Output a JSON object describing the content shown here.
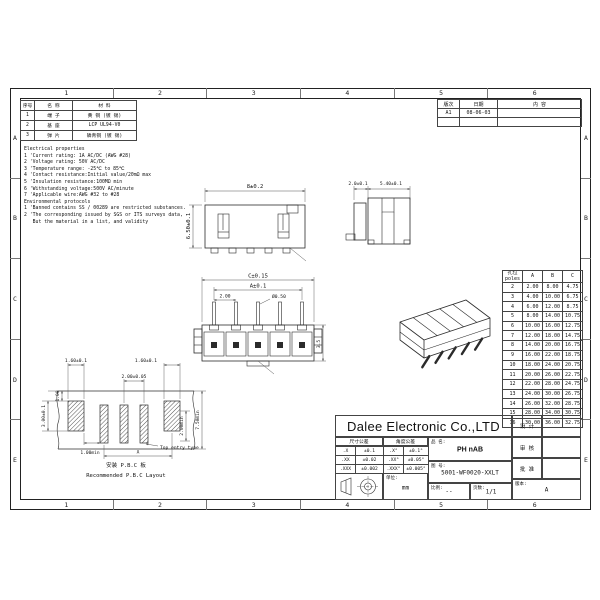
{
  "frame": {
    "cols": [
      "1",
      "2",
      "3",
      "4",
      "5",
      "6"
    ],
    "rows": [
      "A",
      "B",
      "C",
      "D",
      "E"
    ]
  },
  "materials_table": {
    "headers": [
      "序号",
      "名 称",
      "材 料"
    ],
    "rows": [
      [
        "1",
        "端 子",
        "黄 铜 (镀 锡)"
      ],
      [
        "2",
        "基 座",
        "LCP UL94-V0"
      ],
      [
        "3",
        "弹 片",
        "磷青铜 (镀 锡)"
      ]
    ]
  },
  "notes": {
    "lines": [
      "Electrical properties",
      "1 'Current rating: 1A AC/DC (AWG #28)",
      "2 'Voltage rating: 50V AC/DC",
      "3 'Temperature range: -25℃ to 85℃",
      "4 'Contact resistance:Initial value/20mΩ max",
      "5 'Insulation resistance:100MΩ min",
      "6 'Withstanding voltage:500V AC/minute",
      "7 'Applicable wire:AWG #32 to #28",
      "Environmental protocols",
      "1 'Banned contains SS / 00289 are restricted substances.",
      "2 'The corresponding issued by SGS or ITS surveys data,",
      "   But the material in a list, and validity"
    ]
  },
  "views": {
    "top_view": {
      "dim_width": "8±0.2",
      "dim_height": "6.50±0.1"
    },
    "side_view": {
      "dim_left": "2.0±0.1",
      "dim_right": "5.40±0.1"
    },
    "front_view": {
      "dim_c": "C±0.15",
      "dim_a": "A±0.1",
      "dim_pitch": "2.00",
      "dim_pin": "Ø0.50",
      "dim_height": "3.5"
    },
    "pcb_layout": {
      "dim_pad_left": "1.60±0.1",
      "dim_pad_right": "1.60±0.1",
      "dim_pitch": "2.00±0.05",
      "dim_edge": "1.00",
      "dim_pad_h": "3.00±0.1",
      "dim_gap": "1.00min",
      "dim_inner": "2.00min",
      "dim_outer": "7.50min",
      "dim_span": "A",
      "entry_label": "Top entry type",
      "caption_cn": "安装 P.B.C 板",
      "caption_en": "Recommended P.B.C Layout"
    }
  },
  "poles_table": {
    "header_cn": "孔位",
    "header_en": "poles",
    "cols": [
      "A",
      "B",
      "C"
    ],
    "rows": [
      [
        "2",
        "2.00",
        "8.00",
        "4.75"
      ],
      [
        "3",
        "4.00",
        "10.00",
        "6.75"
      ],
      [
        "4",
        "6.00",
        "12.00",
        "8.75"
      ],
      [
        "5",
        "8.00",
        "14.00",
        "10.75"
      ],
      [
        "6",
        "10.00",
        "16.00",
        "12.75"
      ],
      [
        "7",
        "12.00",
        "18.00",
        "14.75"
      ],
      [
        "8",
        "14.00",
        "20.00",
        "16.75"
      ],
      [
        "9",
        "16.00",
        "22.00",
        "18.75"
      ],
      [
        "10",
        "18.00",
        "24.00",
        "20.75"
      ],
      [
        "11",
        "20.00",
        "26.00",
        "22.75"
      ],
      [
        "12",
        "22.00",
        "28.00",
        "24.75"
      ],
      [
        "13",
        "24.00",
        "30.00",
        "26.75"
      ],
      [
        "14",
        "26.00",
        "32.00",
        "28.75"
      ],
      [
        "15",
        "28.00",
        "34.00",
        "30.75"
      ],
      [
        "16",
        "30.00",
        "36.00",
        "32.75"
      ]
    ]
  },
  "revision_table": {
    "headers": [
      "版次",
      "日期",
      "内 容"
    ],
    "rows": [
      [
        "A1",
        "08-06-03",
        ""
      ],
      [
        "",
        "",
        ""
      ]
    ]
  },
  "title_block": {
    "company": "Dalee Electronic Co.,LTD",
    "tol_dim_header": "尺寸公差",
    "tol_ang_header": "角度公差",
    "tol_rows": [
      [
        ".X",
        "±0.1",
        ".X°",
        "±0.1°"
      ],
      [
        ".XX",
        "±0.02",
        ".XX°",
        "±0.05°"
      ],
      [
        ".XXX",
        "±0.002",
        ".XXX°",
        "±0.005°"
      ]
    ],
    "part_label": "品 名:",
    "part_value": "PH nAB",
    "drawing_label": "图 号:",
    "drawing_value": "5001-WF0020-XXLT",
    "unit_label": "单位:",
    "unit_value": "mm",
    "scale_label": "比例:",
    "scale_value": "--",
    "pages_label": "页数:",
    "pages_value": "1/1",
    "design_label": "设 计",
    "review_label": "审 核",
    "approve_label": "批 准",
    "version_label": "版本:",
    "version_value": "A"
  }
}
